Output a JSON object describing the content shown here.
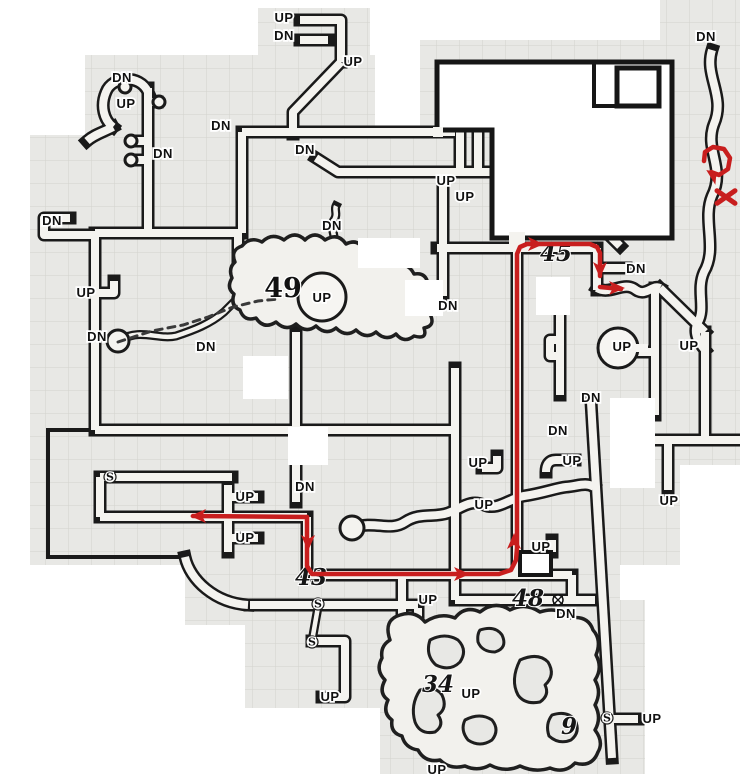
{
  "map": {
    "width": 740,
    "height": 774,
    "colors": {
      "paper": "#e8e8e5",
      "grid_line": "#d2d2cd",
      "wall": "#1a1a1a",
      "floor": "#f4f3ef",
      "route": "#c81e1e",
      "erasure": "#ffffff"
    }
  },
  "room_numbers": [
    {
      "label": "49",
      "x": 283,
      "y": 289,
      "style": "printed"
    },
    {
      "label": "45",
      "x": 556,
      "y": 253,
      "style": "hand"
    },
    {
      "label": "43",
      "x": 311,
      "y": 577,
      "style": "hand"
    },
    {
      "label": "48",
      "x": 528,
      "y": 598,
      "style": "hand"
    },
    {
      "label": "34",
      "x": 438,
      "y": 684,
      "style": "hand"
    },
    {
      "label": "9",
      "x": 569,
      "y": 726,
      "style": "hand"
    }
  ],
  "stair_labels": [
    {
      "text": "UP",
      "x": 284,
      "y": 18
    },
    {
      "text": "DN",
      "x": 284,
      "y": 36
    },
    {
      "text": "UP",
      "x": 353,
      "y": 62
    },
    {
      "text": "DN",
      "x": 122,
      "y": 78
    },
    {
      "text": "UP",
      "x": 126,
      "y": 104
    },
    {
      "text": "DN",
      "x": 221,
      "y": 126
    },
    {
      "text": "DN",
      "x": 163,
      "y": 154
    },
    {
      "text": "DN",
      "x": 305,
      "y": 150
    },
    {
      "text": "UP",
      "x": 446,
      "y": 181
    },
    {
      "text": "UP",
      "x": 465,
      "y": 197
    },
    {
      "text": "DN",
      "x": 706,
      "y": 37
    },
    {
      "text": "DN",
      "x": 52,
      "y": 221
    },
    {
      "text": "DN",
      "x": 332,
      "y": 226
    },
    {
      "text": "DN",
      "x": 636,
      "y": 269
    },
    {
      "text": "UP",
      "x": 86,
      "y": 293
    },
    {
      "text": "UP",
      "x": 322,
      "y": 298
    },
    {
      "text": "DN",
      "x": 448,
      "y": 306
    },
    {
      "text": "DN",
      "x": 97,
      "y": 337
    },
    {
      "text": "DN",
      "x": 206,
      "y": 347
    },
    {
      "text": "UP",
      "x": 622,
      "y": 347
    },
    {
      "text": "UP",
      "x": 689,
      "y": 346
    },
    {
      "text": "DN",
      "x": 591,
      "y": 398
    },
    {
      "text": "DN",
      "x": 558,
      "y": 431
    },
    {
      "text": "UP",
      "x": 572,
      "y": 461
    },
    {
      "text": "UP",
      "x": 478,
      "y": 463
    },
    {
      "text": "DN",
      "x": 305,
      "y": 487
    },
    {
      "text": "UP",
      "x": 245,
      "y": 497
    },
    {
      "text": "UP",
      "x": 484,
      "y": 505
    },
    {
      "text": "UP",
      "x": 669,
      "y": 501
    },
    {
      "text": "UP",
      "x": 245,
      "y": 538
    },
    {
      "text": "UP",
      "x": 541,
      "y": 547
    },
    {
      "text": "UP",
      "x": 428,
      "y": 600
    },
    {
      "text": "DN",
      "x": 566,
      "y": 614
    },
    {
      "text": "UP",
      "x": 471,
      "y": 694
    },
    {
      "text": "UP",
      "x": 330,
      "y": 697
    },
    {
      "text": "UP",
      "x": 652,
      "y": 719
    },
    {
      "text": "UP",
      "x": 437,
      "y": 770
    }
  ],
  "secret_doors": [
    {
      "text": "S",
      "x": 110,
      "y": 477
    },
    {
      "text": "S",
      "x": 318,
      "y": 604
    },
    {
      "text": "S",
      "x": 312,
      "y": 642
    },
    {
      "text": "S",
      "x": 607,
      "y": 718
    }
  ],
  "door_symbol": {
    "glyph": "circled-x",
    "x": 558,
    "y": 600
  },
  "dashed_trail": {
    "color": "#3a3a3a",
    "points": [
      [
        118,
        342
      ],
      [
        152,
        331
      ],
      [
        183,
        325
      ],
      [
        208,
        317
      ],
      [
        233,
        307
      ],
      [
        258,
        301
      ],
      [
        278,
        299
      ]
    ]
  },
  "route": {
    "color": "#c81e1e",
    "width": 4.5,
    "segments": [
      {
        "points": [
          [
            193,
            516
          ],
          [
            307,
            517
          ]
        ]
      },
      {
        "points": [
          [
            307,
            517
          ],
          [
            307,
            566
          ],
          [
            312,
            574
          ],
          [
            499,
            574
          ],
          [
            511,
            570
          ],
          [
            516,
            560
          ],
          [
            517,
            548
          ],
          [
            517,
            254
          ],
          [
            520,
            247
          ],
          [
            527,
            244
          ],
          [
            590,
            244
          ],
          [
            597,
            247
          ],
          [
            600,
            253
          ],
          [
            600,
            276
          ]
        ]
      },
      {
        "points": [
          [
            600,
            287
          ],
          [
            621,
            289
          ]
        ]
      },
      {
        "points": [
          [
            704,
            161
          ],
          [
            705,
            152
          ],
          [
            713,
            147
          ],
          [
            724,
            149
          ],
          [
            730,
            158
          ],
          [
            728,
            169
          ],
          [
            719,
            175
          ],
          [
            711,
            172
          ]
        ]
      }
    ],
    "arrows": [
      {
        "x": 197,
        "y": 516,
        "angle": 180
      },
      {
        "x": 308,
        "y": 544,
        "angle": 90
      },
      {
        "x": 463,
        "y": 574,
        "angle": 0
      },
      {
        "x": 514,
        "y": 540,
        "angle": 270
      },
      {
        "x": 537,
        "y": 244,
        "angle": 0
      },
      {
        "x": 600,
        "y": 271,
        "angle": 90
      },
      {
        "x": 618,
        "y": 288,
        "angle": 0
      },
      {
        "x": 712,
        "y": 174,
        "angle": 215
      }
    ],
    "x_mark": {
      "x": 726,
      "y": 197,
      "size": 9
    }
  }
}
